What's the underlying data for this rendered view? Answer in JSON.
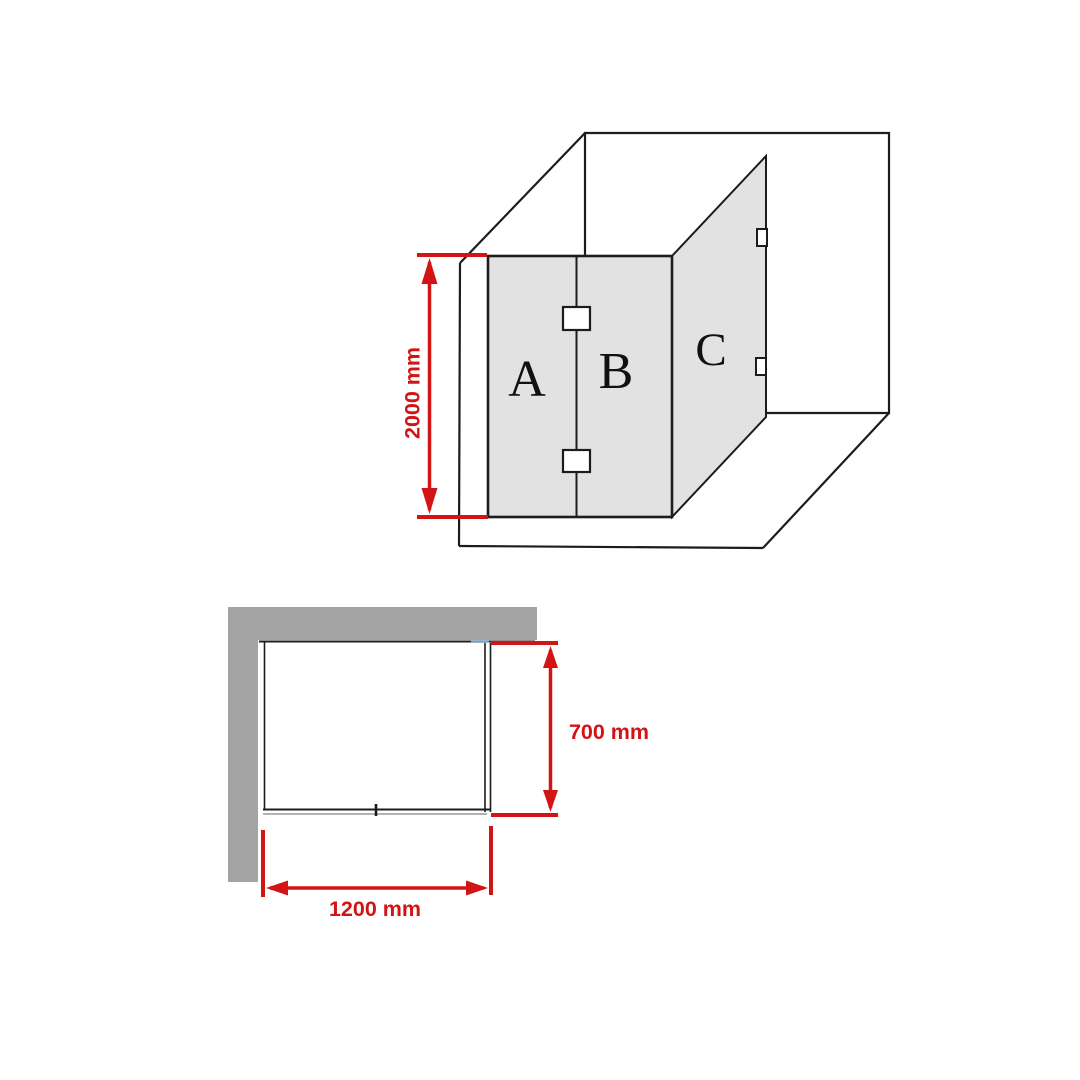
{
  "document": {
    "kind": "shower-screen-dimension-diagram"
  },
  "colors": {
    "dimension_red": "#d31414",
    "glass_gray": "#e2e2e2",
    "wall_gray": "#a4a4a4",
    "line_black": "#1c1c1c",
    "blue_tick": "#7e9cb8",
    "hinge_white": "#ffffff",
    "background": "#ffffff"
  },
  "isometric_view": {
    "description": "3D corner view of shower enclosure with three glass panels",
    "panel_labels": {
      "a": "A",
      "b": "B",
      "c": "C"
    },
    "height_dimension": {
      "label": "2000 mm"
    }
  },
  "plan_view": {
    "description": "Top-down plan view of shower enclosure in wall corner",
    "depth_dimension": {
      "label": "700 mm"
    },
    "width_dimension": {
      "label": "1200 mm"
    }
  }
}
